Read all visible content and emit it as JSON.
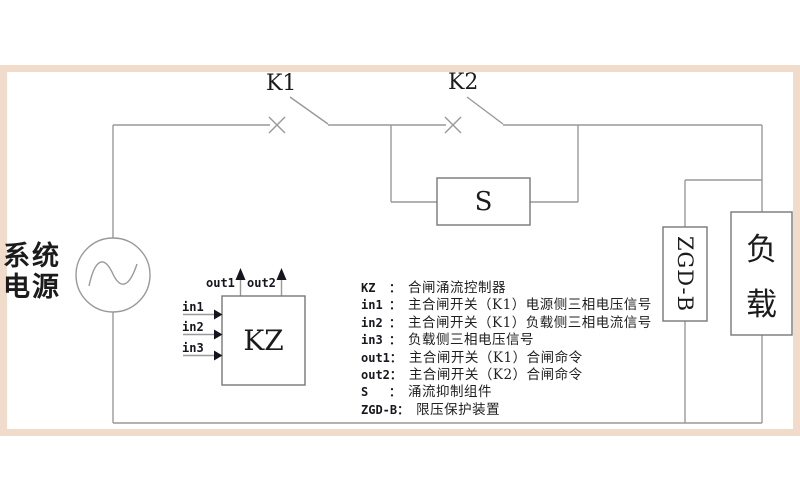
{
  "diagram": {
    "power_source_label_line1": "系统",
    "power_source_label_line2": "电源",
    "switch_k1_label": "K1",
    "switch_k2_label": "K2",
    "suppressor_label": "S",
    "controller_label": "KZ",
    "protector_label": "ZGD-B",
    "load_label_char1": "负",
    "load_label_char2": "载",
    "port_in1": "in1",
    "port_in2": "in2",
    "port_in3": "in3",
    "port_out1": "out1",
    "port_out2": "out2"
  },
  "legend": {
    "colon": "：",
    "rows": [
      {
        "term": "KZ",
        "desc": "合闸涌流控制器"
      },
      {
        "term": "in1",
        "desc": "主合闸开关（K1）电源侧三相电压信号"
      },
      {
        "term": "in2",
        "desc": "主合闸开关（K1）负载侧三相电流信号"
      },
      {
        "term": "in3",
        "desc": "负载侧三相电压信号"
      },
      {
        "term": "out1",
        "desc": "主合闸开关（K1）合闸命令"
      },
      {
        "term": "out2",
        "desc": "主合闸开关（K2）合闸命令"
      },
      {
        "term": "S",
        "desc": "涌流抑制组件"
      },
      {
        "term": "ZGD-B",
        "desc": "限压保护装置"
      }
    ]
  },
  "colors": {
    "frame": "#f1dccb",
    "wire": "#999999",
    "box_border": "#777777",
    "text": "#1b1b1b",
    "arrowhead": "#15151f"
  }
}
